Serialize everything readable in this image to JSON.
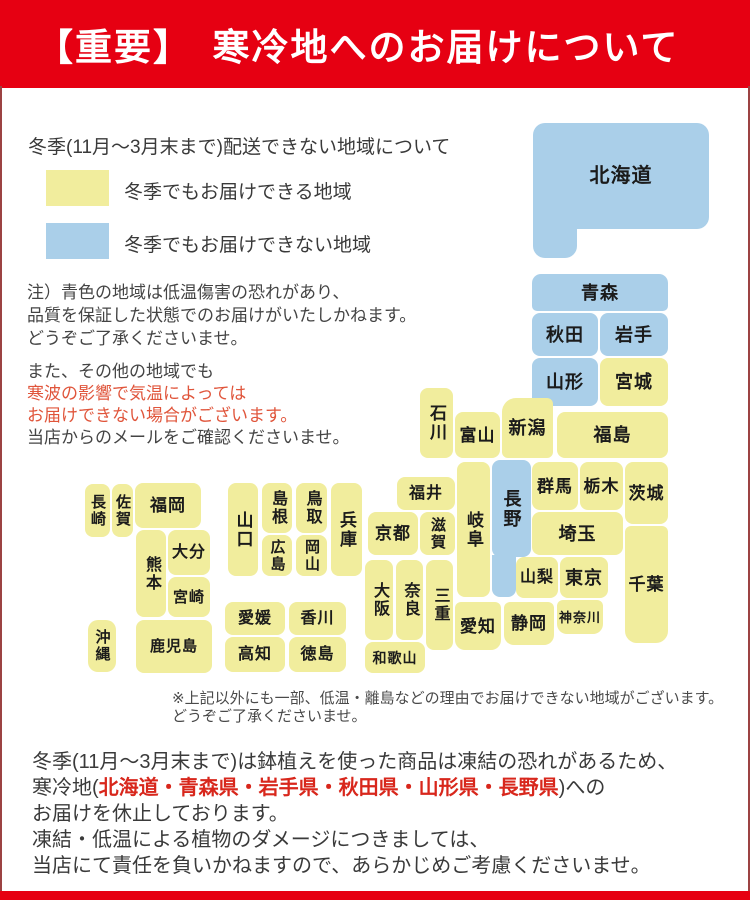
{
  "colors": {
    "header_red": "#e60012",
    "bottom_bar": "#e60012",
    "border": "#9c4343",
    "note_red": "#e0553b",
    "footer_red": "#d8271c",
    "map_ok": "#f1ed9d",
    "map_ng": "#aacfe9"
  },
  "header": {
    "title": "【重要】　寒冷地へのお届けについて"
  },
  "legend": {
    "heading": "冬季(11月～3月末まで)配送できない地域について",
    "items": [
      {
        "key": "winter-deliverable",
        "color": "#f1ed9d",
        "label": "冬季でもお届けできる地域"
      },
      {
        "key": "winter-not-deliverable",
        "color": "#aacfe9",
        "label": "冬季でもお届けできない地域"
      }
    ]
  },
  "notes": {
    "para1": [
      "注）青色の地域は低温傷害の恐れがあり、",
      "品質を保証した状態でのお届けがいたしかねます。",
      "どうぞご了承くださいませ。"
    ],
    "para2": {
      "line1": "また、その他の地域でも",
      "line2": "寒波の影響で気温によっては",
      "line3": "お届けできない場合がございます。",
      "line4": "当店からのメールをご確認くださいませ。"
    }
  },
  "map": {
    "colors": {
      "ok": "#f1ed9d",
      "ng": "#aacfe9"
    },
    "prefectures": [
      {
        "key": "hokkaido",
        "name": "北海道",
        "x": 533,
        "y": 123,
        "w": 176,
        "h": 106,
        "s": "ng",
        "fs": 20,
        "r": "12px"
      },
      {
        "key": "hokkaido-foot",
        "name": "",
        "x": 533,
        "y": 215,
        "w": 44,
        "h": 43,
        "s": "ng",
        "r": "0 0 12px 12px"
      },
      {
        "key": "aomori",
        "name": "青森",
        "x": 532,
        "y": 274,
        "w": 136,
        "h": 37,
        "s": "ng",
        "r": "9px 9px 5px 5px"
      },
      {
        "key": "akita",
        "name": "秋田",
        "x": 532,
        "y": 313,
        "w": 66,
        "h": 43,
        "s": "ng"
      },
      {
        "key": "iwate",
        "name": "岩手",
        "x": 600,
        "y": 313,
        "w": 68,
        "h": 43,
        "s": "ng"
      },
      {
        "key": "yamagata",
        "name": "山形",
        "x": 532,
        "y": 358,
        "w": 66,
        "h": 48,
        "s": "ng"
      },
      {
        "key": "miyagi",
        "name": "宮城",
        "x": 600,
        "y": 358,
        "w": 68,
        "h": 48,
        "s": "ok"
      },
      {
        "key": "fukushima",
        "name": "福島",
        "x": 557,
        "y": 412,
        "w": 111,
        "h": 46,
        "s": "ok"
      },
      {
        "key": "niigata",
        "name": "新潟",
        "x": 502,
        "y": 398,
        "w": 51,
        "h": 60,
        "s": "ok",
        "r": "14px 6px 6px 6px"
      },
      {
        "key": "toyama",
        "name": "富山",
        "x": 455,
        "y": 412,
        "w": 45,
        "h": 46,
        "s": "ok",
        "fs": 17
      },
      {
        "key": "ishikawa",
        "name": "石川",
        "x": 420,
        "y": 388,
        "w": 33,
        "h": 70,
        "s": "ok",
        "o": "v",
        "fs": 17
      },
      {
        "key": "fukui",
        "name": "福井",
        "x": 397,
        "y": 477,
        "w": 58,
        "h": 33,
        "s": "ok",
        "fs": 16
      },
      {
        "key": "gunma",
        "name": "群馬",
        "x": 532,
        "y": 462,
        "w": 46,
        "h": 48,
        "s": "ok",
        "fs": 17
      },
      {
        "key": "tochigi",
        "name": "栃木",
        "x": 580,
        "y": 462,
        "w": 43,
        "h": 48,
        "s": "ok",
        "fs": 17
      },
      {
        "key": "ibaraki",
        "name": "茨城",
        "x": 625,
        "y": 462,
        "w": 43,
        "h": 62,
        "s": "ok",
        "fs": 17
      },
      {
        "key": "saitama",
        "name": "埼玉",
        "x": 532,
        "y": 512,
        "w": 91,
        "h": 43,
        "s": "ok"
      },
      {
        "key": "chiba",
        "name": "千葉",
        "x": 625,
        "y": 526,
        "w": 43,
        "h": 117,
        "s": "ok",
        "fs": 17,
        "r": "6px 6px 12px 12px"
      },
      {
        "key": "nagano",
        "name": "長野",
        "x": 492,
        "y": 460,
        "w": 39,
        "h": 97,
        "s": "ng",
        "o": "v"
      },
      {
        "key": "nagano-south",
        "name": "",
        "x": 492,
        "y": 555,
        "w": 24,
        "h": 42,
        "s": "ng",
        "r": "0 0 8px 8px"
      },
      {
        "key": "gifu",
        "name": "岐阜",
        "x": 457,
        "y": 462,
        "w": 33,
        "h": 135,
        "s": "ok",
        "o": "v",
        "fs": 17
      },
      {
        "key": "yamanashi",
        "name": "山梨",
        "x": 516,
        "y": 557,
        "w": 42,
        "h": 41,
        "s": "ok",
        "fs": 16
      },
      {
        "key": "tokyo",
        "name": "東京",
        "x": 560,
        "y": 557,
        "w": 48,
        "h": 41,
        "s": "ok"
      },
      {
        "key": "kanagawa",
        "name": "神奈川",
        "x": 557,
        "y": 600,
        "w": 46,
        "h": 34,
        "s": "ok",
        "fs": 13,
        "r": "6px 6px 10px 10px"
      },
      {
        "key": "shizuoka",
        "name": "静岡",
        "x": 504,
        "y": 602,
        "w": 50,
        "h": 43,
        "s": "ok",
        "fs": 17,
        "r": "6px 6px 10px 10px"
      },
      {
        "key": "aichi",
        "name": "愛知",
        "x": 455,
        "y": 602,
        "w": 46,
        "h": 48,
        "s": "ok",
        "fs": 17,
        "r": "6px 6px 10px 10px"
      },
      {
        "key": "shiga",
        "name": "滋賀",
        "x": 420,
        "y": 512,
        "w": 35,
        "h": 43,
        "s": "ok",
        "o": "v",
        "fs": 15
      },
      {
        "key": "kyoto",
        "name": "京都",
        "x": 368,
        "y": 512,
        "w": 50,
        "h": 43,
        "s": "ok",
        "fs": 17
      },
      {
        "key": "osaka",
        "name": "大阪",
        "x": 365,
        "y": 560,
        "w": 28,
        "h": 80,
        "s": "ok",
        "o": "v",
        "fs": 16
      },
      {
        "key": "nara",
        "name": "奈良",
        "x": 396,
        "y": 560,
        "w": 27,
        "h": 80,
        "s": "ok",
        "o": "v",
        "fs": 16
      },
      {
        "key": "mie",
        "name": "三重",
        "x": 426,
        "y": 560,
        "w": 27,
        "h": 90,
        "s": "ok",
        "o": "v",
        "fs": 16
      },
      {
        "key": "wakayama",
        "name": "和歌山",
        "x": 365,
        "y": 642,
        "w": 60,
        "h": 31,
        "s": "ok",
        "fs": 14
      },
      {
        "key": "hyogo",
        "name": "兵庫",
        "x": 331,
        "y": 483,
        "w": 31,
        "h": 93,
        "s": "ok",
        "o": "v",
        "fs": 17
      },
      {
        "key": "tottori",
        "name": "鳥取",
        "x": 296,
        "y": 483,
        "w": 31,
        "h": 50,
        "s": "ok",
        "o": "v",
        "fs": 16
      },
      {
        "key": "shimane",
        "name": "島根",
        "x": 262,
        "y": 483,
        "w": 30,
        "h": 50,
        "s": "ok",
        "o": "v",
        "fs": 16
      },
      {
        "key": "okayama",
        "name": "岡山",
        "x": 296,
        "y": 535,
        "w": 31,
        "h": 41,
        "s": "ok",
        "o": "v",
        "fs": 15
      },
      {
        "key": "hiroshima",
        "name": "広島",
        "x": 262,
        "y": 535,
        "w": 30,
        "h": 41,
        "s": "ok",
        "o": "v",
        "fs": 15
      },
      {
        "key": "yamaguchi",
        "name": "山口",
        "x": 228,
        "y": 483,
        "w": 30,
        "h": 93,
        "s": "ok",
        "o": "v",
        "fs": 17
      },
      {
        "key": "ehime",
        "name": "愛媛",
        "x": 225,
        "y": 602,
        "w": 60,
        "h": 33,
        "s": "ok",
        "fs": 16
      },
      {
        "key": "kagawa",
        "name": "香川",
        "x": 289,
        "y": 602,
        "w": 57,
        "h": 33,
        "s": "ok",
        "fs": 16
      },
      {
        "key": "kochi",
        "name": "高知",
        "x": 225,
        "y": 637,
        "w": 60,
        "h": 35,
        "s": "ok",
        "fs": 16
      },
      {
        "key": "tokushima",
        "name": "徳島",
        "x": 289,
        "y": 637,
        "w": 57,
        "h": 35,
        "s": "ok",
        "fs": 16
      },
      {
        "key": "fukuoka",
        "name": "福岡",
        "x": 135,
        "y": 483,
        "w": 66,
        "h": 45,
        "s": "ok",
        "fs": 17
      },
      {
        "key": "saga",
        "name": "佐賀",
        "x": 112,
        "y": 484,
        "w": 21,
        "h": 53,
        "s": "ok",
        "o": "v",
        "fs": 15
      },
      {
        "key": "nagasaki",
        "name": "長崎",
        "x": 85,
        "y": 484,
        "w": 25,
        "h": 53,
        "s": "ok",
        "o": "v",
        "fs": 15
      },
      {
        "key": "kumamoto",
        "name": "熊本",
        "x": 136,
        "y": 530,
        "w": 30,
        "h": 87,
        "s": "ok",
        "o": "v",
        "fs": 16
      },
      {
        "key": "oita",
        "name": "大分",
        "x": 168,
        "y": 530,
        "w": 42,
        "h": 45,
        "s": "ok",
        "fs": 16
      },
      {
        "key": "miyazaki",
        "name": "宮崎",
        "x": 168,
        "y": 577,
        "w": 42,
        "h": 40,
        "s": "ok",
        "fs": 15
      },
      {
        "key": "kagoshima",
        "name": "鹿児島",
        "x": 136,
        "y": 620,
        "w": 76,
        "h": 53,
        "s": "ok",
        "fs": 15
      },
      {
        "key": "okinawa",
        "name": "沖縄",
        "x": 88,
        "y": 620,
        "w": 28,
        "h": 52,
        "s": "ok",
        "o": "v",
        "fs": 15,
        "r": "10px"
      }
    ]
  },
  "map_note": {
    "line1": "※上記以外にも一部、低温・離島などの理由でお届けできない地域がございます。",
    "line2": "どうぞご了承くださいませ。"
  },
  "footer": {
    "line1": "冬季(11月～3月末まで)は鉢植えを使った商品は凍結の恐れがあるため、",
    "line2_prefix": "寒冷地(",
    "line2_red": "北海道・青森県・岩手県・秋田県・山形県・長野県",
    "line2_suffix": ")への",
    "line3": "お届けを休止しております。",
    "line4": "凍結・低温による植物のダメージにつきましては、",
    "line5": "当店にて責任を負いかねますので、あらかじめご考慮くださいませ。"
  }
}
